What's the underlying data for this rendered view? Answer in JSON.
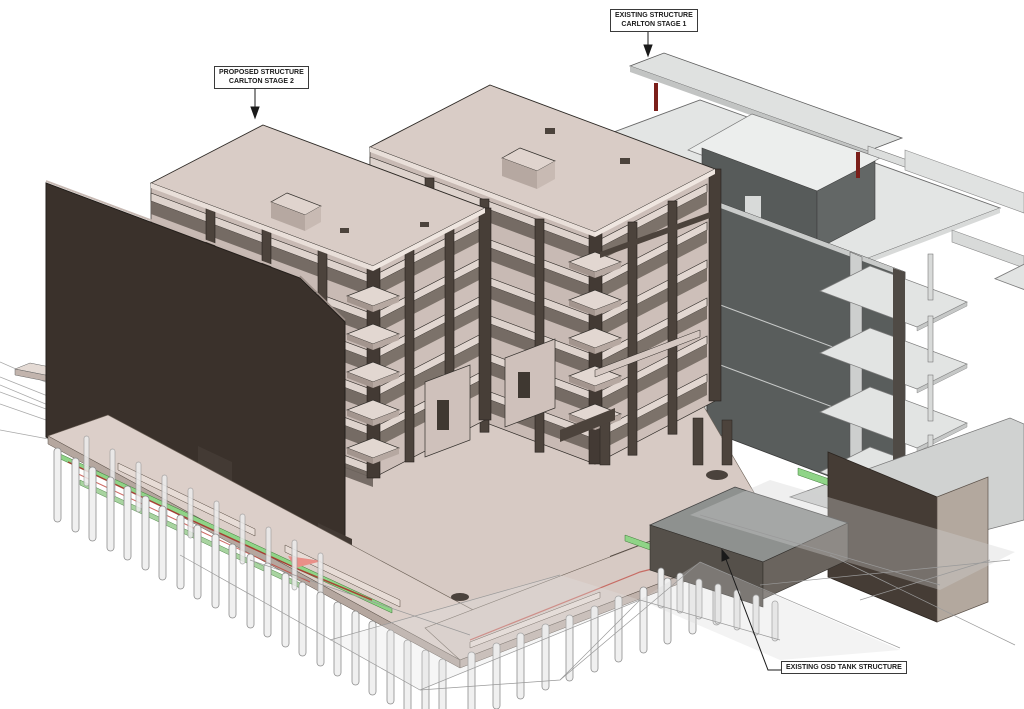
{
  "view": {
    "name": "3D structural model view",
    "background": "#ffffff"
  },
  "annotations": {
    "proposed": {
      "line1": "PROPOSED STRUCTURE",
      "line2": "CARLTON STAGE 2"
    },
    "existing": {
      "line1": "EXISTING STRUCTURE",
      "line2": "CARLTON STAGE 1"
    },
    "osd": {
      "line1": "EXISTING OSD TANK STRUCTURE"
    }
  },
  "palette": {
    "slab_top_beige": "#d9ccc6",
    "slab_light_beige": "#e7dcd6",
    "wall_dark_brown": "#3a312b",
    "column_dark_brown": "#4c433c",
    "shadow_brown": "#6e645d",
    "existing_gray_roof": "#e3e5e4",
    "existing_gray_face": "#d6d8d7",
    "existing_wall_dark_gray": "#595d5c",
    "red_column": "#7b1f1a",
    "green_capping_beam": "#8fd487",
    "pile_gray": "#f0f0f0",
    "tank_gray_top": "#8e918f",
    "tank_dark_face": "#55504a",
    "block_taupe_side": "#b3a89e",
    "wireframe_gray": "#9a9a9a"
  }
}
